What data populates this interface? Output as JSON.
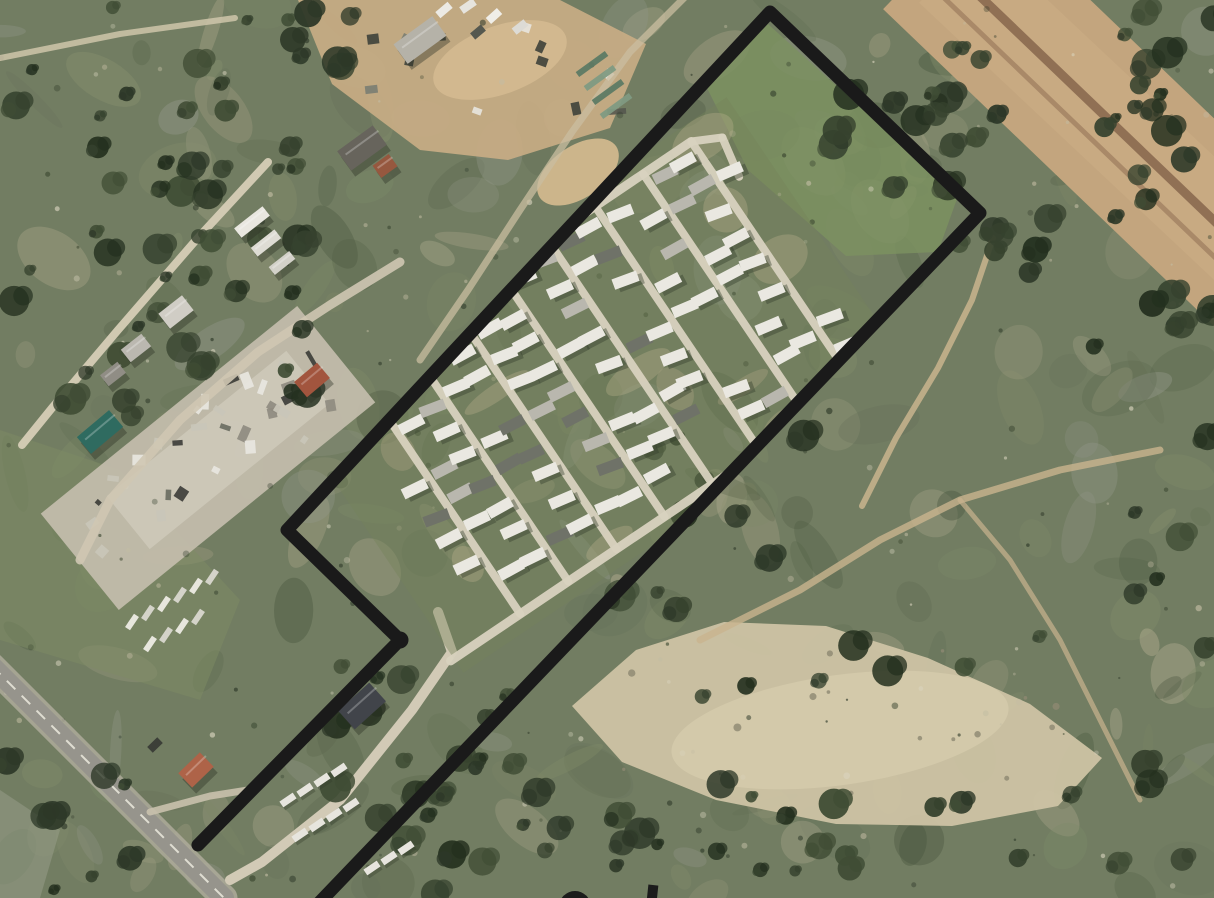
{
  "view": {
    "width": 1214,
    "height": 898,
    "kind": "satellite-aerial-imagery",
    "visible_text": "none"
  },
  "annotation": {
    "boundary": {
      "color": "#1a1a1a",
      "stroke_width": 13,
      "open_ends": true,
      "vertices": [
        [
          198,
          845
        ],
        [
          400,
          640
        ],
        [
          287,
          530
        ],
        [
          770,
          12
        ],
        [
          980,
          213
        ],
        [
          316,
          906
        ]
      ],
      "corner_dots": [
        [
          400,
          640
        ]
      ],
      "clip_vertices": [
        [
          204,
          840
        ],
        [
          400,
          633
        ],
        [
          293,
          527
        ],
        [
          770,
          22
        ],
        [
          971,
          215
        ],
        [
          322,
          892
        ]
      ]
    }
  },
  "watermark": {
    "color": "#1c1c1c",
    "glyphs": [
      {
        "shape": "circle",
        "cx": 575,
        "cy": 907,
        "r": 16
      },
      {
        "shape": "rect",
        "cx": 652,
        "cy": 898,
        "w": 10,
        "h": 26,
        "rot": 6
      },
      {
        "shape": "circle",
        "cx": 666,
        "cy": 908,
        "r": 9
      }
    ]
  },
  "terrain": {
    "base": "#727d62",
    "noise_palette": [
      "#5b684d",
      "#4a573f",
      "#89916f",
      "#a7a387",
      "#b9b195",
      "#93988a",
      "#66715a",
      "#7e8a68"
    ],
    "noise_count": 260,
    "speckle_count": 210,
    "speckle_palette": [
      "#39452f",
      "#2d3828",
      "#c3bda4",
      "#dad5c0"
    ],
    "tree_palette": [
      "#36422e",
      "#2d3828",
      "#404d35",
      "#24301f"
    ],
    "tree_zones": [
      {
        "x": 0,
        "y": 55,
        "w": 330,
        "h": 380,
        "n": 46
      },
      {
        "x": 0,
        "y": 0,
        "w": 360,
        "h": 70,
        "n": 10
      },
      {
        "x": 820,
        "y": 10,
        "w": 190,
        "h": 180,
        "n": 16
      },
      {
        "x": 1090,
        "y": 0,
        "w": 124,
        "h": 220,
        "n": 16
      },
      {
        "x": 400,
        "y": 755,
        "w": 330,
        "h": 140,
        "n": 20
      },
      {
        "x": 690,
        "y": 630,
        "w": 500,
        "h": 265,
        "n": 24
      },
      {
        "x": 1130,
        "y": 290,
        "w": 84,
        "h": 360,
        "n": 12
      },
      {
        "x": 285,
        "y": 630,
        "w": 230,
        "h": 190,
        "n": 12
      },
      {
        "x": 560,
        "y": 430,
        "w": 250,
        "h": 190,
        "n": 10
      },
      {
        "x": 940,
        "y": 190,
        "w": 160,
        "h": 160,
        "n": 8
      },
      {
        "x": 0,
        "y": 760,
        "w": 150,
        "h": 135,
        "n": 8
      }
    ],
    "regions": {
      "green_field_apex": {
        "points": [
          [
            706,
            86
          ],
          [
            768,
            24
          ],
          [
            958,
            196
          ],
          [
            938,
            252
          ],
          [
            846,
            256
          ],
          [
            748,
            170
          ]
        ],
        "fill": "#7b9160",
        "opacity": 0.85
      },
      "left_fields": {
        "points": [
          [
            0,
            430
          ],
          [
            120,
            470
          ],
          [
            240,
            600
          ],
          [
            200,
            700
          ],
          [
            0,
            640
          ]
        ],
        "fill": "#7e8c63",
        "opacity": 0.5
      },
      "top_yard": {
        "points": [
          [
            298,
            0
          ],
          [
            560,
            0
          ],
          [
            646,
            44
          ],
          [
            610,
            128
          ],
          [
            508,
            160
          ],
          [
            420,
            150
          ],
          [
            332,
            84
          ]
        ],
        "fill": "#c8ad84",
        "opacity": 0.92
      },
      "clearing": {
        "points": [
          [
            572,
            706
          ],
          [
            636,
            650
          ],
          [
            724,
            622
          ],
          [
            826,
            626
          ],
          [
            928,
            658
          ],
          [
            1030,
            704
          ],
          [
            1102,
            758
          ],
          [
            1058,
            806
          ],
          [
            952,
            826
          ],
          [
            836,
            824
          ],
          [
            716,
            800
          ],
          [
            622,
            762
          ]
        ],
        "fill": "#cdc3a4",
        "opacity": 0.95
      },
      "corner_grass": {
        "points": [
          [
            0,
            790
          ],
          [
            60,
            830
          ],
          [
            40,
            898
          ],
          [
            0,
            898
          ]
        ],
        "fill": "#9aa08c",
        "opacity": 0.5
      }
    },
    "top_yard_mound": {
      "cx": 500,
      "cy": 60,
      "rx": 70,
      "ry": 34,
      "rot": -20,
      "fill": "#d6bc92",
      "opacity": 0.8
    },
    "bright_mound": {
      "cx": 578,
      "cy": 172,
      "rx": 46,
      "ry": 26,
      "rot": -34,
      "fill": "#d6bb90",
      "opacity": 0.9
    },
    "clearing_core": {
      "cx": 840,
      "cy": 730,
      "rx": 170,
      "ry": 55,
      "rot": -8,
      "fill": "#d7cdae",
      "opacity": 0.7
    },
    "corridor": {
      "band": {
        "x1": 935,
        "y1": -45,
        "x2": 1290,
        "y2": 295,
        "w": 150,
        "color": "#c3a57e"
      },
      "band_core": {
        "x1": 950,
        "y1": -30,
        "x2": 1280,
        "y2": 280,
        "w": 90,
        "color": "#ccae86",
        "opacity": 0.6
      },
      "track_main": {
        "x1": 963,
        "y1": -20,
        "x2": 1253,
        "y2": 258,
        "w": 9,
        "color": "#8a6a50",
        "opacity": 0.9
      },
      "track_faint": {
        "x1": 941,
        "y1": -5,
        "x2": 1228,
        "y2": 270,
        "w": 5,
        "color": "#9c7c5e",
        "opacity": 0.7
      }
    },
    "junkyard": {
      "cx": 208,
      "cy": 458,
      "w": 330,
      "h": 124,
      "rot": -39,
      "fill": "#c2bcab",
      "core": "#d0cabb",
      "debris_n": 30,
      "debris_palette": [
        "#3e3e39",
        "#e8e6df",
        "#8f8b80",
        "#6b6e62",
        "#c9c5b8"
      ]
    }
  },
  "roads": {
    "list": [
      {
        "name": "topleft-path",
        "pts": [
          [
            0,
            58
          ],
          [
            120,
            34
          ],
          [
            235,
            18
          ]
        ],
        "w": 6,
        "color": "#cfc5aa",
        "op": 0.85
      },
      {
        "name": "top-dirt-road",
        "pts": [
          [
            688,
            -6
          ],
          [
            630,
            52
          ],
          [
            572,
            132
          ],
          [
            520,
            210
          ],
          [
            468,
            290
          ],
          [
            420,
            360
          ]
        ],
        "w": 7,
        "color": "#c9bda0",
        "op": 0.75
      },
      {
        "name": "residential-road",
        "pts": [
          [
            268,
            162
          ],
          [
            196,
            240
          ],
          [
            118,
            330
          ],
          [
            52,
            408
          ],
          [
            22,
            445
          ]
        ],
        "w": 8,
        "color": "#d6cdb6",
        "op": 0.95
      },
      {
        "name": "mid-road",
        "pts": [
          [
            400,
            262
          ],
          [
            330,
            305
          ],
          [
            258,
            352
          ],
          [
            180,
            420
          ],
          [
            110,
            500
          ],
          [
            80,
            560
          ]
        ],
        "w": 9,
        "color": "#cfc7b2",
        "op": 0.9
      },
      {
        "name": "entrance-road",
        "pts": [
          [
            438,
            612
          ],
          [
            452,
            652
          ],
          [
            412,
            710
          ],
          [
            340,
            800
          ],
          [
            262,
            862
          ],
          [
            230,
            880
          ]
        ],
        "w": 10,
        "color": "#d2cab6",
        "op": 1
      },
      {
        "name": "driveway",
        "pts": [
          [
            150,
            812
          ],
          [
            210,
            796
          ],
          [
            248,
            790
          ]
        ],
        "w": 7,
        "color": "#c9c1ad",
        "op": 0.9
      },
      {
        "name": "scrub-path-1",
        "pts": [
          [
            993,
            238
          ],
          [
            972,
            300
          ],
          [
            938,
            368
          ],
          [
            896,
            438
          ],
          [
            862,
            506
          ]
        ],
        "w": 6,
        "color": "#c9b48e",
        "op": 0.85
      },
      {
        "name": "scrub-path-2",
        "pts": [
          [
            700,
            640
          ],
          [
            800,
            590
          ],
          [
            880,
            540
          ],
          [
            960,
            500
          ],
          [
            1060,
            470
          ],
          [
            1160,
            450
          ]
        ],
        "w": 7,
        "color": "#c9b48e",
        "op": 0.8
      },
      {
        "name": "scrub-path-3",
        "pts": [
          [
            960,
            500
          ],
          [
            1010,
            560
          ],
          [
            1060,
            640
          ],
          [
            1100,
            720
          ],
          [
            1140,
            800
          ]
        ],
        "w": 5,
        "color": "#c9b48e",
        "op": 0.7
      }
    ],
    "highway": {
      "pts": [
        [
          -8,
          666
        ],
        [
          86,
          760
        ],
        [
          178,
          852
        ],
        [
          224,
          898
        ]
      ],
      "w": 20,
      "color": "#96948c",
      "shoulder_w": 27,
      "shoulder_color": "#b2ae9f",
      "centerline": "#eceade",
      "dash": "12 9"
    }
  },
  "structures": {
    "shadow": {
      "fill": "#2c3326",
      "op": 0.4,
      "dx": 4,
      "dy": 6
    },
    "houses": [
      {
        "cx": 420,
        "cy": 40,
        "w": 48,
        "h": 24,
        "rot": -36,
        "fill": "#b5b2a8"
      },
      {
        "cx": 362,
        "cy": 148,
        "w": 44,
        "h": 24,
        "rot": -36,
        "fill": "#67645c"
      },
      {
        "cx": 385,
        "cy": 166,
        "w": 20,
        "h": 15,
        "rot": -36,
        "fill": "#96583f"
      },
      {
        "cx": 252,
        "cy": 222,
        "w": 36,
        "h": 12,
        "rot": -38,
        "fill": "#e9e7e0"
      },
      {
        "cx": 266,
        "cy": 243,
        "w": 30,
        "h": 11,
        "rot": -38,
        "fill": "#dedcd4"
      },
      {
        "cx": 282,
        "cy": 263,
        "w": 26,
        "h": 10,
        "rot": -38,
        "fill": "#d3d1c9"
      },
      {
        "cx": 176,
        "cy": 312,
        "w": 30,
        "h": 19,
        "rot": -38,
        "fill": "#d0cdc5"
      },
      {
        "cx": 136,
        "cy": 348,
        "w": 26,
        "h": 16,
        "rot": -38,
        "fill": "#bbb8b0"
      },
      {
        "cx": 113,
        "cy": 374,
        "w": 22,
        "h": 14,
        "rot": -38,
        "fill": "#908d85"
      },
      {
        "cx": 312,
        "cy": 380,
        "w": 30,
        "h": 20,
        "rot": -40,
        "fill": "#a2553e"
      },
      {
        "cx": 100,
        "cy": 432,
        "w": 42,
        "h": 22,
        "rot": -40,
        "fill": "#2f6b60"
      },
      {
        "cx": 362,
        "cy": 706,
        "w": 42,
        "h": 25,
        "rot": -42,
        "fill": "#41444a"
      },
      {
        "cx": 196,
        "cy": 770,
        "w": 30,
        "h": 20,
        "rot": -44,
        "fill": "#ae6348"
      }
    ],
    "vehicles": [
      {
        "cx": 444,
        "cy": 10,
        "w": 16,
        "h": 8,
        "rot": -40,
        "fill": "#eceae4"
      },
      {
        "cx": 468,
        "cy": 6,
        "w": 16,
        "h": 8,
        "rot": -35,
        "fill": "#e6e4de"
      },
      {
        "cx": 494,
        "cy": 16,
        "w": 15,
        "h": 8,
        "rot": -42,
        "fill": "#f0eee8"
      },
      {
        "cx": 520,
        "cy": 27,
        "w": 15,
        "h": 8,
        "rot": -38,
        "fill": "#dddbd5"
      },
      {
        "cx": 478,
        "cy": 32,
        "w": 14,
        "h": 8,
        "rot": -40,
        "fill": "#55584f"
      },
      {
        "cx": 155,
        "cy": 745,
        "w": 14,
        "h": 8,
        "rot": -44,
        "fill": "#3c3f38"
      }
    ],
    "material_stacks": {
      "start_x": 592,
      "start_y": 64,
      "dx": 8,
      "dy": 14,
      "n": 4,
      "w": 36,
      "h": 6,
      "rot": -36,
      "colors": [
        "#5d7a64",
        "#7f9a82"
      ]
    },
    "stored_trailer_rows": [
      {
        "sx": 132,
        "sy": 622,
        "dx": 16,
        "dy": -9,
        "n": 6,
        "w": 16,
        "h": 6,
        "rot": -56
      },
      {
        "sx": 150,
        "sy": 644,
        "dx": 16,
        "dy": -9,
        "n": 4,
        "w": 16,
        "h": 6,
        "rot": -56
      }
    ],
    "sw_trailers": [
      {
        "cx": 288,
        "cy": 800
      },
      {
        "cx": 305,
        "cy": 790
      },
      {
        "cx": 322,
        "cy": 780
      },
      {
        "cx": 339,
        "cy": 770
      },
      {
        "cx": 300,
        "cy": 835
      },
      {
        "cx": 317,
        "cy": 825
      },
      {
        "cx": 334,
        "cy": 815
      },
      {
        "cx": 351,
        "cy": 805
      },
      {
        "cx": 372,
        "cy": 868
      },
      {
        "cx": 389,
        "cy": 858
      },
      {
        "cx": 406,
        "cy": 848
      }
    ],
    "sw_trailer_style": {
      "w": 16,
      "h": 7,
      "rot": -34,
      "fill": "#e7e5de"
    }
  },
  "park": {
    "center": [
      595,
      385
    ],
    "rotation": -34,
    "tint": {
      "w": 540,
      "h": 330,
      "fill": "#75845b",
      "opacity": 0.42
    },
    "lane_u": [
      -190,
      -132,
      -74,
      -16,
      42,
      100,
      158,
      216
    ],
    "lane_v": [
      -148,
      148
    ],
    "lane_w": 8,
    "lane_color": "#d9d2bf",
    "connectors": [
      {
        "u1": -190,
        "v1": -148,
        "u2": 216,
        "v2": -148,
        "w": 9
      },
      {
        "u1": -274,
        "v1": 148,
        "u2": 110,
        "v2": 148,
        "w": 9
      },
      {
        "u1": 216,
        "v1": -148,
        "u2": 244,
        "v2": -134,
        "w": 8
      },
      {
        "u1": 244,
        "v1": -134,
        "u2": 236,
        "v2": -92,
        "w": 8
      }
    ],
    "trailer": {
      "len": 26,
      "hgt": 11,
      "side_off": 17,
      "v_start": -132,
      "v_end": 132,
      "v_step": 30,
      "presence": 0.68,
      "base_rot": 9,
      "rot_jitter": 5,
      "colors": {
        "white": "#eae8e1",
        "gray": "#b9b7ae",
        "dark": "#6f7268"
      },
      "shadow": {
        "fill": "#333d2b",
        "op": 0.4,
        "dx": 3,
        "dy": 5
      }
    },
    "tan_patches": {
      "n": 12,
      "colors": [
        "#b9ac8a",
        "#c8bb96"
      ]
    }
  }
}
